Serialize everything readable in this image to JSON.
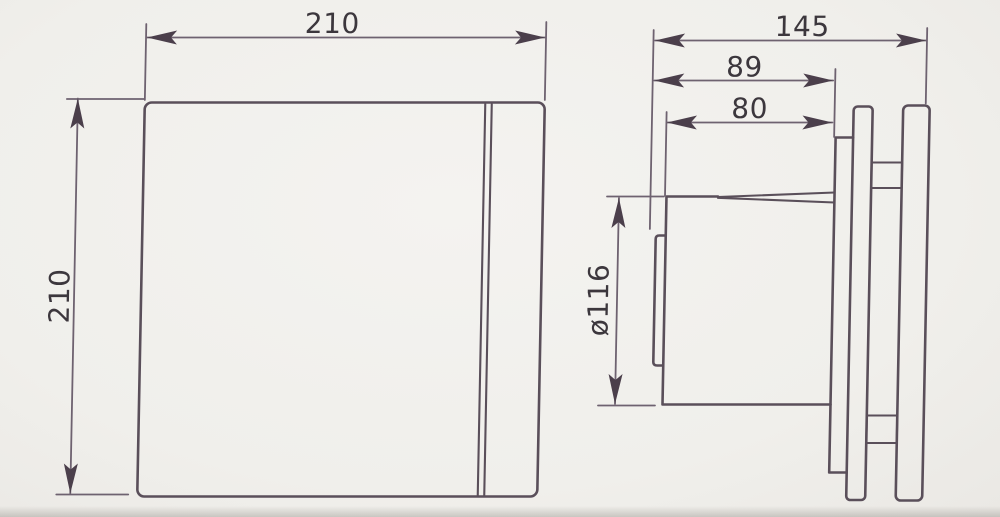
{
  "front_view": {
    "width_label": "210",
    "height_label": "210"
  },
  "side_view": {
    "total_depth_label": "145",
    "duct_overall_depth_label": "89",
    "duct_length_label": "80",
    "duct_diameter_label": "ø116"
  },
  "colors": {
    "paper": "#f0efeb",
    "line": "#5a4f5a",
    "dim_line": "#6e6270",
    "arrow": "#4b3f4b",
    "text": "#3c373d",
    "shadow": "#8a8680"
  }
}
